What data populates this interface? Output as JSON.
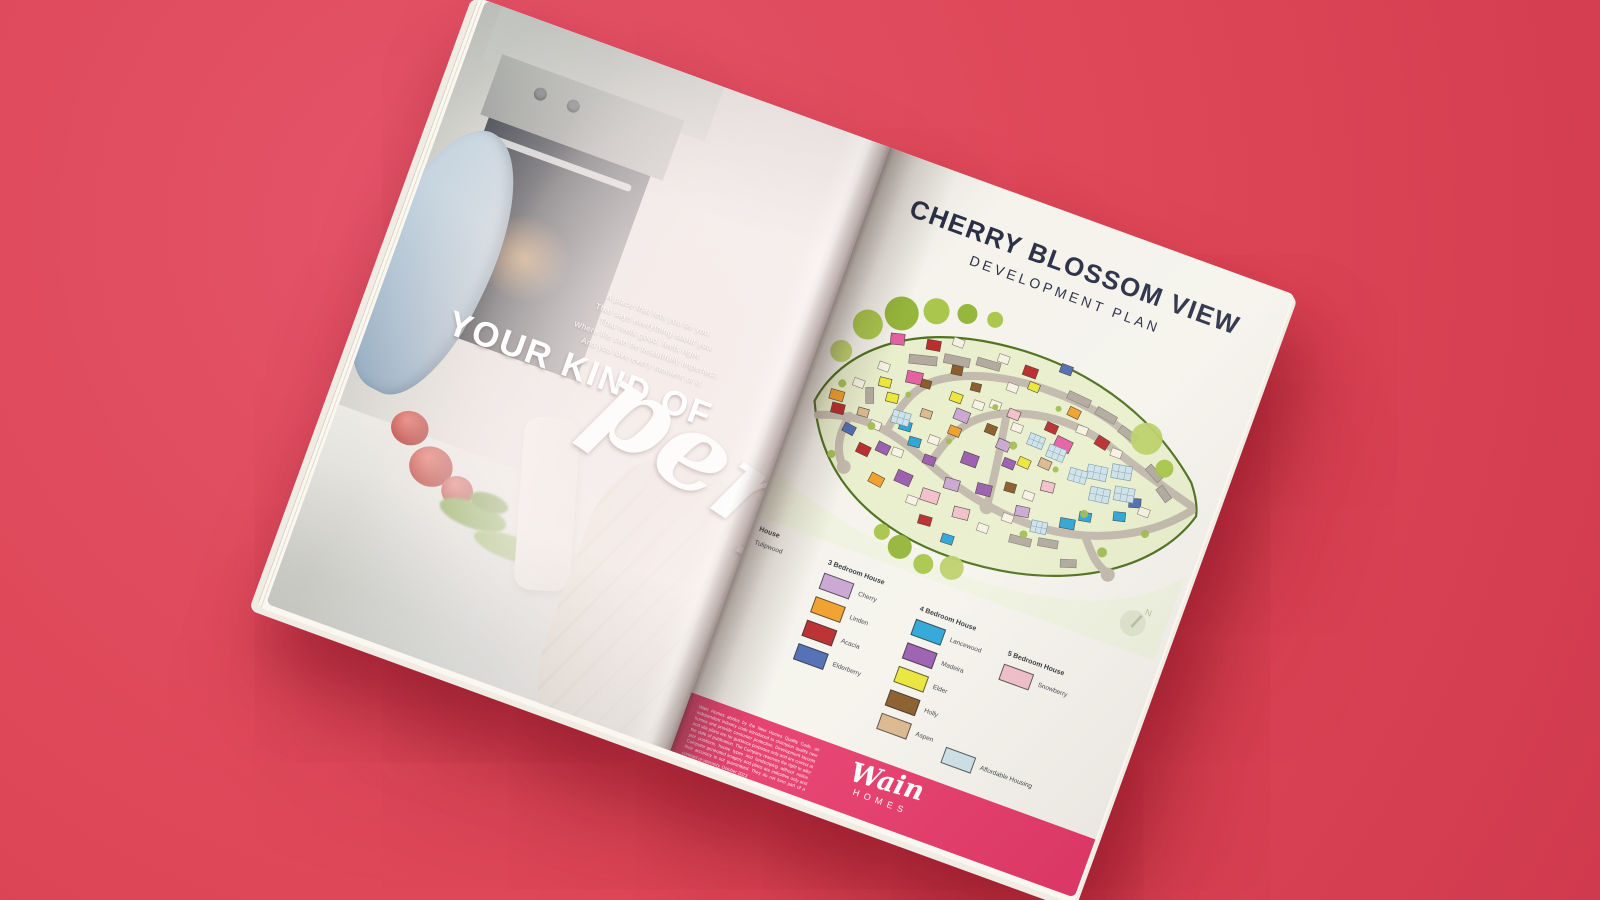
{
  "palette": {
    "background": "#dd4656",
    "background_light": "#e4546a",
    "background_dark": "#d03a4e",
    "page": "#f5f3ec",
    "title_ink": "#2b3046",
    "band": "#e63a6a"
  },
  "left_page": {
    "tagline_lines": [
      "A place that lets you be you.",
      "That says everything about you.",
      "That feels good, feels right.",
      "Where life can be beautifully imperfect.",
      "And you love every moment of it."
    ],
    "headline": "YOUR KIND OF",
    "headline_script": "perf"
  },
  "right_page": {
    "title": "CHERRY BLOSSOM VIEW",
    "subtitle": "DEVELOPMENT PLAN",
    "legend": {
      "columns": [
        {
          "header": "House",
          "items": [
            {
              "label": "Tulipwood",
              "color": null
            }
          ]
        },
        {
          "header": "3 Bedroom House",
          "items": [
            {
              "label": "Cherry",
              "color": "#c9a6d2"
            },
            {
              "label": "Linden",
              "color": "#f09f2a"
            },
            {
              "label": "Acacia",
              "color": "#b92b2b"
            },
            {
              "label": "Elderberry",
              "color": "#4f6cb4"
            }
          ]
        },
        {
          "header": "4 Bedroom House",
          "items": [
            {
              "label": "Lancewood",
              "color": "#2ba5d8"
            },
            {
              "label": "Madeira",
              "color": "#9a5cae"
            },
            {
              "label": "Elder",
              "color": "#ece63a"
            },
            {
              "label": "Holly",
              "color": "#8a5a28"
            },
            {
              "label": "Aspen",
              "color": "#dcb88d"
            }
          ]
        },
        {
          "header": "5 Bedroom House",
          "items": [
            {
              "label": "Snowberry",
              "color": "#f2bfca"
            }
          ]
        }
      ],
      "affordable": {
        "label": "Affordable Housing",
        "color": "#cfe2e9"
      }
    },
    "disclaimer": "Wain Homes abides by the New Homes Quality Code, an independent industry code introduced to champion quality new homes and provide consumer protection. Development layouts and site plans are for guidance purposes only and are correct at the date of publication. The Company reserves the right to alter plot positions, house types and landscaping without notice. Computer generated imagery and plans are indicative only and their accuracy is not guaranteed. They do not form part of a contract or warranty. October 2023",
    "brand": {
      "name": "Wain",
      "sub": "HOMES"
    }
  },
  "map": {
    "compass_label": "N",
    "field_color": "#e9efcd",
    "outer_field_color": "#f0f3e0",
    "boundary_color": "#4e701d",
    "road_color": "#c2b9ac",
    "plot_colors": {
      "red": "#b92b2b",
      "orange": "#f09f2a",
      "magenta": "#e45fa2",
      "lilac": "#c9a6d2",
      "purple": "#9a5cae",
      "yellow": "#ece63a",
      "cyan": "#2ba5d8",
      "blue": "#4f6cb4",
      "brown": "#8a5a28",
      "tan": "#dcb88d",
      "pink": "#f2bfca",
      "grey": "#b1a99e",
      "afford": "#cfe2e9",
      "white": "#f6f2e3"
    },
    "tree_colors": [
      "#a5c342",
      "#8fb232",
      "#bad066",
      "#9fba4e"
    ],
    "plots": [
      {
        "x": 84,
        "y": 68,
        "w": 28,
        "h": 9,
        "c": "grey",
        "r": -14
      },
      {
        "x": 117,
        "y": 57,
        "w": 26,
        "h": 9,
        "c": "grey",
        "r": -8
      },
      {
        "x": 149,
        "y": 50,
        "w": 24,
        "h": 8,
        "c": "grey",
        "r": -4
      },
      {
        "x": 246,
        "y": 52,
        "w": 24,
        "h": 8,
        "c": "grey",
        "r": 5
      },
      {
        "x": 278,
        "y": 58,
        "w": 22,
        "h": 8,
        "c": "grey",
        "r": 10
      },
      {
        "x": 306,
        "y": 68,
        "w": 20,
        "h": 8,
        "c": "grey",
        "r": 16
      },
      {
        "x": 345,
        "y": 96,
        "w": 18,
        "h": 8,
        "c": "grey",
        "r": 28
      },
      {
        "x": 362,
        "y": 112,
        "w": 16,
        "h": 8,
        "c": "grey",
        "r": 34
      },
      {
        "x": 240,
        "y": 205,
        "w": 22,
        "h": 8,
        "c": "grey",
        "r": -6
      },
      {
        "x": 268,
        "y": 198,
        "w": 20,
        "h": 8,
        "c": "grey",
        "r": -10
      },
      {
        "x": 52,
        "y": 120,
        "w": 16,
        "h": 8,
        "c": "grey",
        "r": 70
      },
      {
        "x": 296,
        "y": 210,
        "w": 16,
        "h": 8,
        "c": "grey",
        "r": -18
      },
      {
        "x": 96,
        "y": 50,
        "w": 14,
        "h": 10,
        "c": "red",
        "r": -10
      },
      {
        "x": 196,
        "y": 42,
        "w": 14,
        "h": 10,
        "c": "red",
        "r": 0
      },
      {
        "x": 288,
        "y": 84,
        "w": 13,
        "h": 10,
        "c": "red",
        "r": 12
      },
      {
        "x": 66,
        "y": 172,
        "w": 13,
        "h": 10,
        "c": "red",
        "r": 6
      },
      {
        "x": 148,
        "y": 218,
        "w": 13,
        "h": 9,
        "c": "red",
        "r": -4
      },
      {
        "x": 236,
        "y": 88,
        "w": 12,
        "h": 9,
        "c": "red",
        "r": 4
      },
      {
        "x": 28,
        "y": 142,
        "w": 13,
        "h": 10,
        "c": "red",
        "r": -6
      },
      {
        "x": 88,
        "y": 86,
        "w": 16,
        "h": 12,
        "c": "magenta",
        "r": -8
      },
      {
        "x": 250,
        "y": 98,
        "w": 17,
        "h": 12,
        "c": "magenta",
        "r": 6
      },
      {
        "x": 60,
        "y": 56,
        "w": 14,
        "h": 11,
        "c": "magenta",
        "r": -14
      },
      {
        "x": 64,
        "y": 102,
        "w": 12,
        "h": 9,
        "c": "yellow",
        "r": -6
      },
      {
        "x": 76,
        "y": 114,
        "w": 12,
        "h": 9,
        "c": "yellow",
        "r": -6
      },
      {
        "x": 136,
        "y": 92,
        "w": 12,
        "h": 9,
        "c": "yellow",
        "r": 0
      },
      {
        "x": 222,
        "y": 130,
        "w": 12,
        "h": 9,
        "c": "yellow",
        "r": 4
      },
      {
        "x": 206,
        "y": 56,
        "w": 11,
        "h": 8,
        "c": "yellow",
        "r": 2
      },
      {
        "x": 146,
        "y": 106,
        "w": 15,
        "h": 11,
        "c": "lilac",
        "r": 2
      },
      {
        "x": 160,
        "y": 174,
        "w": 15,
        "h": 11,
        "c": "lilac",
        "r": -4
      },
      {
        "x": 196,
        "y": 120,
        "w": 13,
        "h": 10,
        "c": "lilac",
        "r": 4
      },
      {
        "x": 236,
        "y": 176,
        "w": 14,
        "h": 10,
        "c": "lilac",
        "r": -8
      },
      {
        "x": 98,
        "y": 136,
        "w": 12,
        "h": 9,
        "c": "cyan",
        "r": -4
      },
      {
        "x": 112,
        "y": 148,
        "w": 12,
        "h": 9,
        "c": "cyan",
        "r": -4
      },
      {
        "x": 282,
        "y": 172,
        "w": 15,
        "h": 10,
        "c": "cyan",
        "r": -10
      },
      {
        "x": 298,
        "y": 160,
        "w": 12,
        "h": 9,
        "c": "cyan",
        "r": -10
      },
      {
        "x": 330,
        "y": 148,
        "w": 12,
        "h": 9,
        "c": "cyan",
        "r": -14
      },
      {
        "x": 176,
        "y": 228,
        "w": 12,
        "h": 9,
        "c": "cyan",
        "r": -2
      },
      {
        "x": 46,
        "y": 158,
        "w": 12,
        "h": 9,
        "c": "blue",
        "r": 8
      },
      {
        "x": 230,
        "y": 28,
        "w": 12,
        "h": 9,
        "c": "blue",
        "r": 0
      },
      {
        "x": 340,
        "y": 130,
        "w": 12,
        "h": 9,
        "c": "blue",
        "r": -16
      },
      {
        "x": 22,
        "y": 130,
        "w": 14,
        "h": 10,
        "c": "orange",
        "r": -4
      },
      {
        "x": 88,
        "y": 196,
        "w": 14,
        "h": 10,
        "c": "orange",
        "r": 8
      },
      {
        "x": 146,
        "y": 124,
        "w": 12,
        "h": 9,
        "c": "orange",
        "r": 2
      },
      {
        "x": 252,
        "y": 66,
        "w": 12,
        "h": 9,
        "c": "orange",
        "r": 6
      },
      {
        "x": 128,
        "y": 66,
        "w": 11,
        "h": 9,
        "c": "brown",
        "r": -8
      },
      {
        "x": 180,
        "y": 110,
        "w": 11,
        "h": 9,
        "c": "brown",
        "r": 2
      },
      {
        "x": 104,
        "y": 90,
        "w": 10,
        "h": 8,
        "c": "brown",
        "r": -4
      },
      {
        "x": 218,
        "y": 158,
        "w": 11,
        "h": 9,
        "c": "brown",
        "r": -4
      },
      {
        "x": 152,
        "y": 76,
        "w": 10,
        "h": 8,
        "c": "brown",
        "r": -6
      },
      {
        "x": 168,
        "y": 144,
        "w": 16,
        "h": 12,
        "c": "purple",
        "r": 0
      },
      {
        "x": 192,
        "y": 168,
        "w": 15,
        "h": 11,
        "c": "purple",
        "r": -6
      },
      {
        "x": 112,
        "y": 184,
        "w": 16,
        "h": 12,
        "c": "purple",
        "r": 4
      },
      {
        "x": 208,
        "y": 136,
        "w": 12,
        "h": 9,
        "c": "purple",
        "r": 2
      },
      {
        "x": 84,
        "y": 164,
        "w": 13,
        "h": 10,
        "c": "purple",
        "r": 6
      },
      {
        "x": 132,
        "y": 160,
        "w": 12,
        "h": 9,
        "c": "purple",
        "r": 0
      },
      {
        "x": 142,
        "y": 192,
        "w": 18,
        "h": 12,
        "c": "pink",
        "r": -2
      },
      {
        "x": 178,
        "y": 198,
        "w": 16,
        "h": 11,
        "c": "pink",
        "r": -6
      },
      {
        "x": 252,
        "y": 144,
        "w": 13,
        "h": 10,
        "c": "pink",
        "r": -6
      },
      {
        "x": 196,
        "y": 88,
        "w": 12,
        "h": 9,
        "c": "pink",
        "r": 2
      },
      {
        "x": 242,
        "y": 124,
        "w": 12,
        "h": 9,
        "c": "tan",
        "r": 4
      },
      {
        "x": 54,
        "y": 138,
        "w": 11,
        "h": 8,
        "c": "tan",
        "r": -4
      },
      {
        "x": 114,
        "y": 118,
        "w": 11,
        "h": 8,
        "c": "tan",
        "r": -2
      },
      {
        "x": 290,
        "y": 112,
        "w": 20,
        "h": 14,
        "c": "afford",
        "r": -8
      },
      {
        "x": 313,
        "y": 103,
        "w": 20,
        "h": 14,
        "c": "afford",
        "r": -10
      },
      {
        "x": 300,
        "y": 132,
        "w": 20,
        "h": 14,
        "c": "afford",
        "r": -8
      },
      {
        "x": 323,
        "y": 123,
        "w": 20,
        "h": 14,
        "c": "afford",
        "r": -10
      },
      {
        "x": 274,
        "y": 122,
        "w": 18,
        "h": 13,
        "c": "afford",
        "r": -4
      },
      {
        "x": 246,
        "y": 108,
        "w": 18,
        "h": 13,
        "c": "afford",
        "r": 2
      },
      {
        "x": 224,
        "y": 104,
        "w": 16,
        "h": 12,
        "c": "afford",
        "r": 2
      },
      {
        "x": 88,
        "y": 128,
        "w": 18,
        "h": 13,
        "c": "afford",
        "r": -4
      },
      {
        "x": 256,
        "y": 184,
        "w": 16,
        "h": 12,
        "c": "afford",
        "r": -8
      },
      {
        "x": 40,
        "y": 112,
        "c": "white"
      },
      {
        "x": 58,
        "y": 88,
        "c": "white"
      },
      {
        "x": 120,
        "y": 40,
        "c": "white"
      },
      {
        "x": 168,
        "y": 40,
        "c": "white"
      },
      {
        "x": 186,
        "y": 64,
        "c": "white"
      },
      {
        "x": 160,
        "y": 92,
        "c": "white"
      },
      {
        "x": 130,
        "y": 140,
        "c": "white"
      },
      {
        "x": 70,
        "y": 146,
        "c": "white"
      },
      {
        "x": 100,
        "y": 164,
        "c": "white"
      },
      {
        "x": 130,
        "y": 204,
        "c": "white"
      },
      {
        "x": 206,
        "y": 206,
        "c": "white"
      },
      {
        "x": 226,
        "y": 188,
        "c": "white"
      },
      {
        "x": 266,
        "y": 80,
        "c": "white"
      },
      {
        "x": 306,
        "y": 90,
        "c": "white"
      },
      {
        "x": 352,
        "y": 136,
        "c": "white"
      },
      {
        "x": 204,
        "y": 100,
        "c": "white"
      },
      {
        "x": 238,
        "y": 160,
        "c": "white"
      },
      {
        "x": 176,
        "y": 86,
        "c": "white"
      }
    ],
    "trees": [
      {
        "x": 34,
        "y": 58,
        "r": 15,
        "c": 0
      },
      {
        "x": 62,
        "y": 36,
        "r": 17,
        "c": 1
      },
      {
        "x": 94,
        "y": 22,
        "r": 13,
        "c": 0
      },
      {
        "x": 18,
        "y": 92,
        "r": 11,
        "c": 2
      },
      {
        "x": 124,
        "y": 14,
        "r": 10,
        "c": 1
      },
      {
        "x": 152,
        "y": 10,
        "r": 8,
        "c": 0
      },
      {
        "x": 335,
        "y": 70,
        "r": 16,
        "c": 2
      },
      {
        "x": 362,
        "y": 92,
        "r": 9,
        "c": 0
      },
      {
        "x": 140,
        "y": 256,
        "r": 12,
        "c": 1
      },
      {
        "x": 168,
        "y": 264,
        "r": 10,
        "c": 0
      },
      {
        "x": 196,
        "y": 258,
        "r": 12,
        "c": 2
      },
      {
        "x": 118,
        "y": 248,
        "r": 8,
        "c": 0
      },
      {
        "x": 72,
        "y": 152,
        "r": 4,
        "c": 3
      },
      {
        "x": 212,
        "y": 122,
        "r": 4,
        "c": 3
      },
      {
        "x": 252,
        "y": 202,
        "r": 4,
        "c": 3
      },
      {
        "x": 302,
        "y": 162,
        "r": 4,
        "c": 3
      },
      {
        "x": 182,
        "y": 92,
        "r": 3,
        "c": 3
      },
      {
        "x": 242,
        "y": 72,
        "r": 3,
        "c": 3
      },
      {
        "x": 44,
        "y": 192,
        "r": 4,
        "c": 3
      },
      {
        "x": 332,
        "y": 192,
        "r": 5,
        "c": 3
      },
      {
        "x": 366,
        "y": 160,
        "r": 4,
        "c": 3
      },
      {
        "x": 30,
        "y": 122,
        "r": 4,
        "c": 3
      },
      {
        "x": 96,
        "y": 110,
        "r": 3,
        "c": 3
      },
      {
        "x": 150,
        "y": 140,
        "r": 3,
        "c": 3
      },
      {
        "x": 260,
        "y": 130,
        "r": 3,
        "c": 3
      }
    ]
  }
}
